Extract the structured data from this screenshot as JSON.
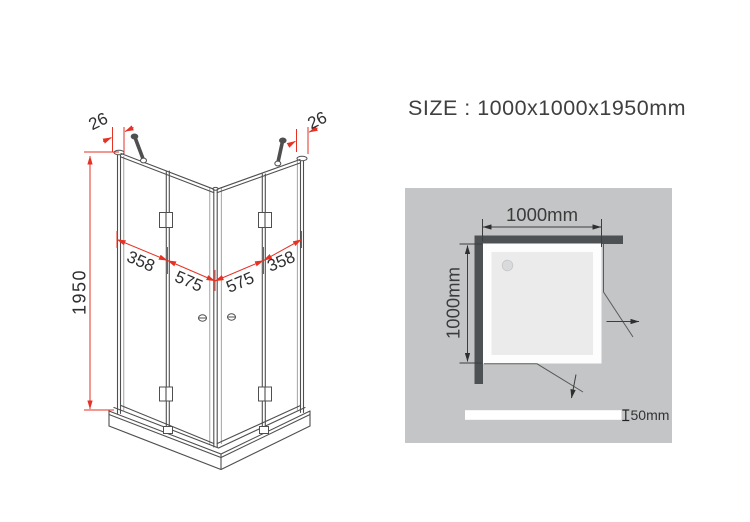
{
  "title": {
    "size_label": "SIZE : 1000x1000x1950mm"
  },
  "iso_view": {
    "top_gap_left": "26",
    "top_gap_right": "26",
    "height": "1950",
    "panel_widths": {
      "left_fixed": "358",
      "left_door": "575",
      "right_door": "575",
      "right_fixed": "358"
    }
  },
  "top_view": {
    "width": "1000mm",
    "depth": "1000mm",
    "tray_height": "50mm"
  },
  "colors": {
    "dimension_red": "#e63125",
    "line_gray": "#4f4f4f",
    "wall_dark": "#4e5154",
    "panel_gray": "#c4c5c6",
    "tray_white": "#fdfdfd",
    "tray_inner": "#ebebeb",
    "text_dark": "#3f3f3f"
  }
}
